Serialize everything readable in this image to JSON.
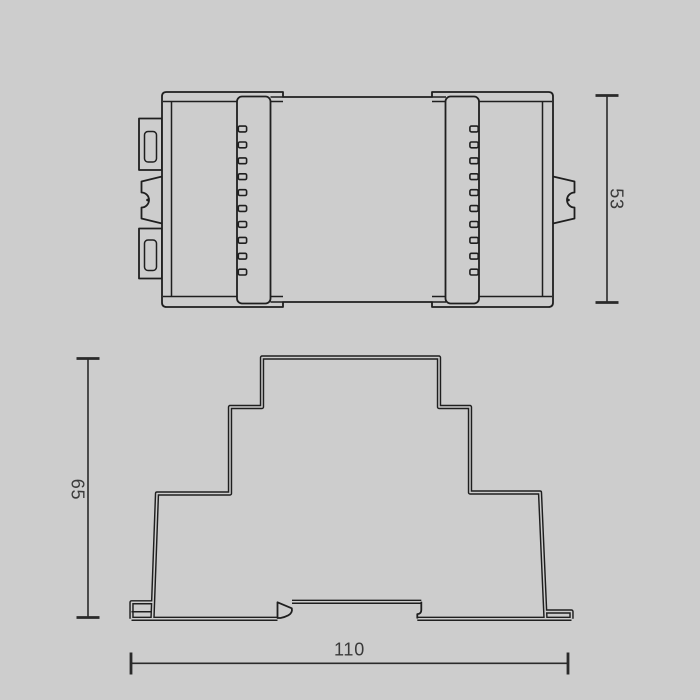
{
  "page": {
    "background": "#cdcdcd",
    "line_color": "#1f1f1f",
    "dim_text_color": "#3a3a3a"
  },
  "drawing": {
    "dimensions": {
      "top_view_height": {
        "label": "53"
      },
      "side_view_height": {
        "label": "65"
      },
      "side_view_width": {
        "label": "110"
      }
    }
  }
}
